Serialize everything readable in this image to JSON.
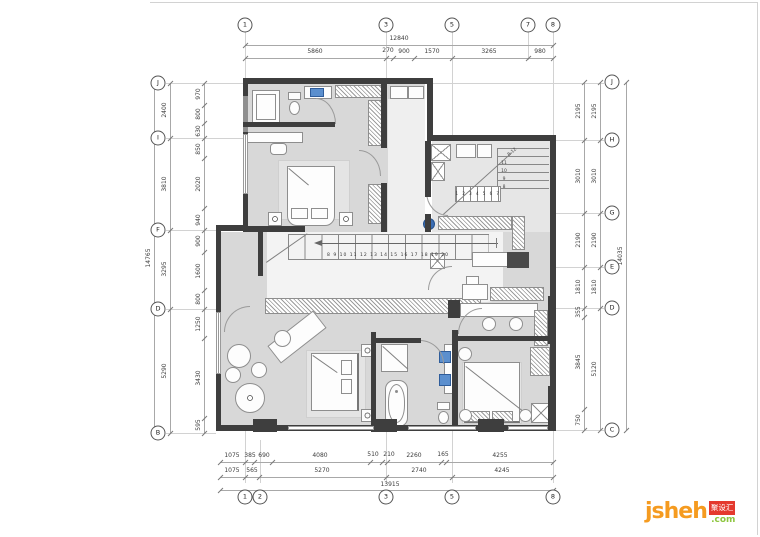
{
  "axes": {
    "top": [
      "1",
      "3",
      "5",
      "7",
      "8"
    ],
    "bottom": [
      "1",
      "2",
      "3",
      "5",
      "8"
    ],
    "left": [
      "J",
      "I",
      "F",
      "D",
      "B"
    ],
    "right": [
      "J",
      "H",
      "G",
      "E",
      "D",
      "C"
    ]
  },
  "dims": {
    "top": {
      "overall": "12840",
      "segs": [
        "5860",
        "270",
        "900",
        "1570",
        "3265",
        "980"
      ]
    },
    "bottom": {
      "row1": [
        "1075",
        "385",
        "690",
        "4080",
        "510",
        "210",
        "2260",
        "165",
        "4255"
      ],
      "row2": [
        "1075",
        "565",
        "5270",
        "2740",
        "4245"
      ],
      "overall": "13915"
    },
    "left": {
      "overall": "14765",
      "spans": [
        "2400",
        "3810",
        "3295",
        "5290"
      ],
      "segs": [
        "970",
        "800",
        "630",
        "850",
        "2020",
        "940",
        "900",
        "1600",
        "800",
        "1250",
        "3430",
        "595"
      ]
    },
    "right": {
      "overall": "14035",
      "spans": [
        "2195",
        "3010",
        "2190",
        "1810",
        "5120"
      ],
      "segs": [
        "2195",
        "3010",
        "2190",
        "1810",
        "355",
        "3845",
        "750"
      ]
    }
  },
  "stairs": {
    "mid_numbers": "8 9 10 11 12 13 14 15 16 17 18 19 20",
    "upper_row": "1 2 3 4 5 6 7",
    "upper_col": [
      "8-12",
      "11",
      "10",
      "9",
      "8"
    ]
  },
  "logo": {
    "name": "jsheh",
    "box": "聚设汇",
    "tld": ".com"
  }
}
